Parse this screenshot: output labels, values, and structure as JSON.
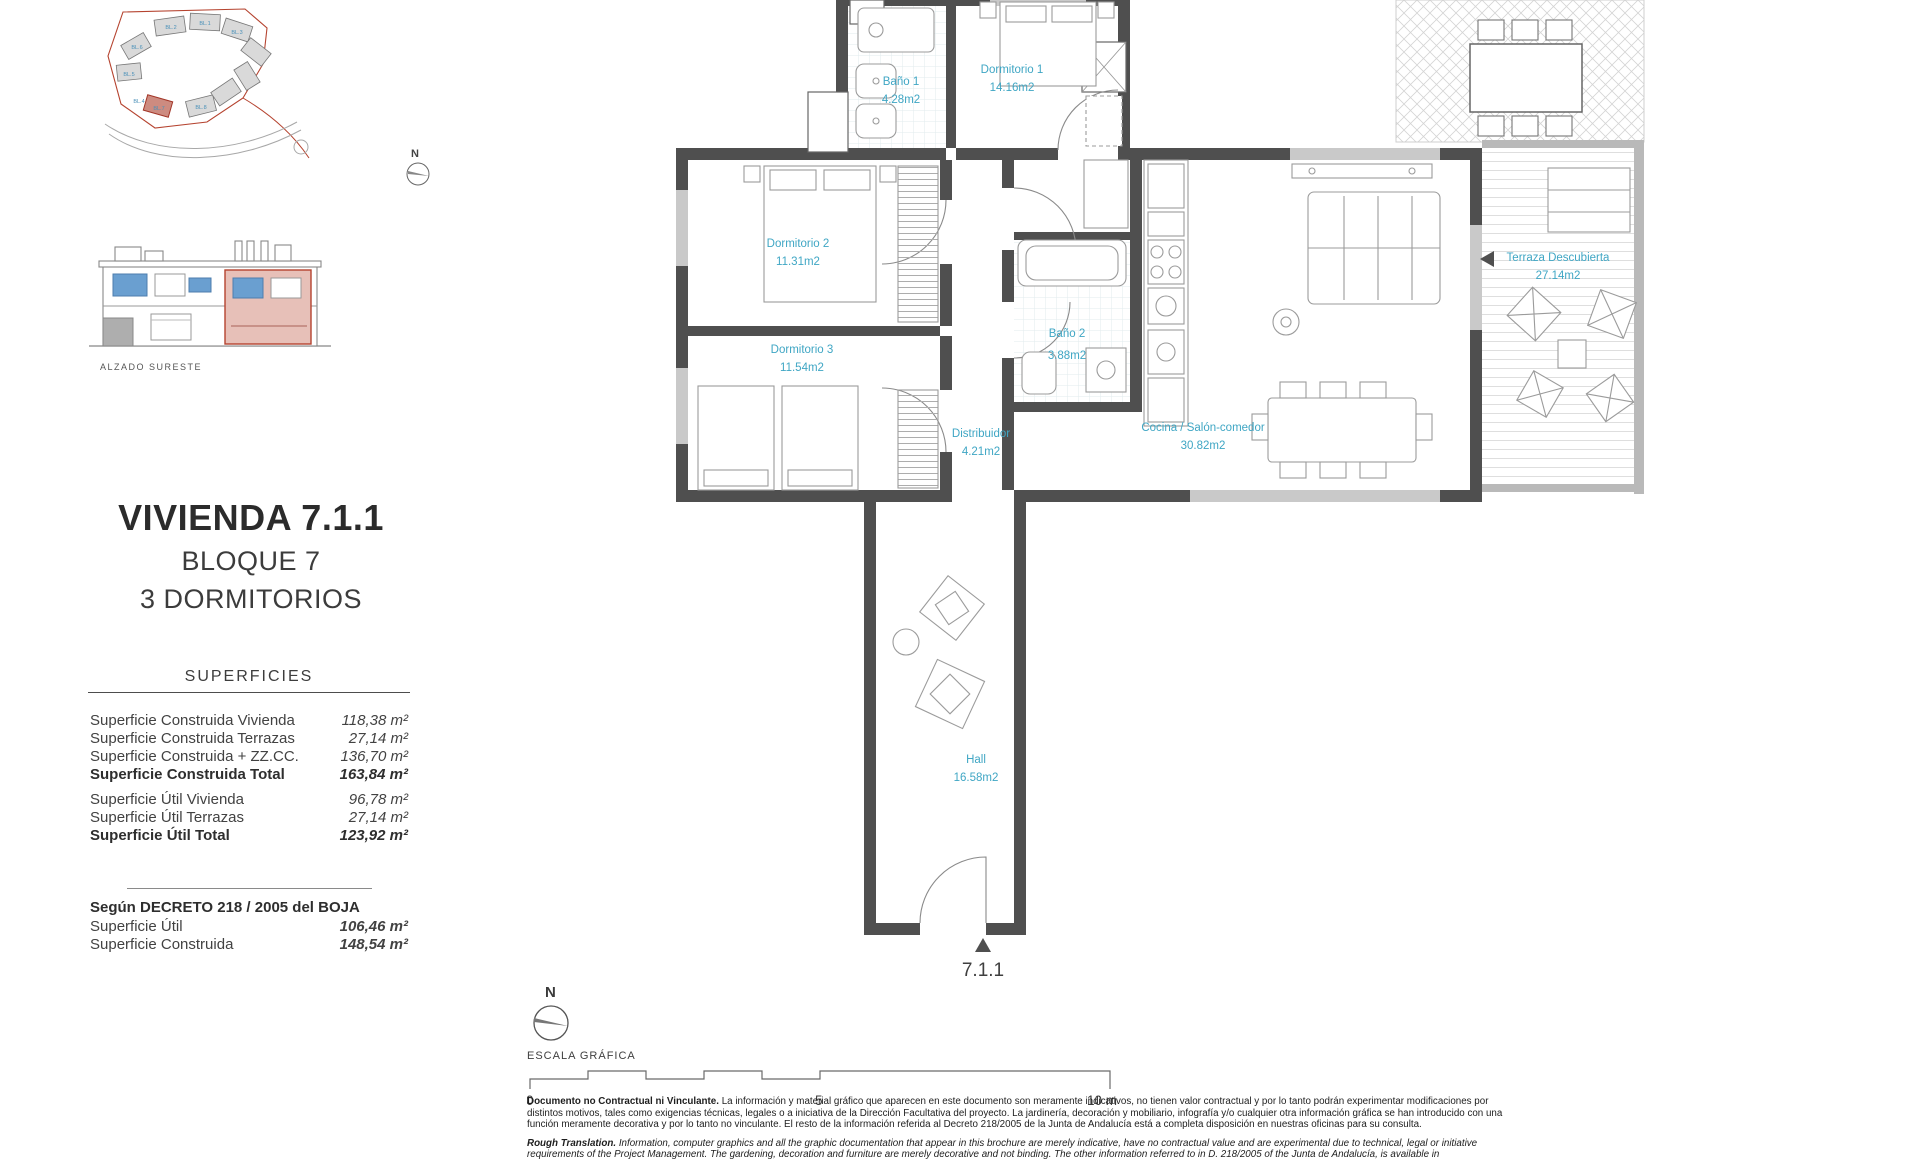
{
  "page_title": "VIVIENDA 7.1.1",
  "subtitle_block": "BLOQUE 7",
  "subtitle_rooms": "3 DORMITORIOS",
  "north": {
    "label": "N"
  },
  "site_plan": {
    "block_labels": [
      "BL.1",
      "BL.2",
      "BL.3",
      "BL.4",
      "BL.5",
      "BL.6",
      "BL.7",
      "BL.8"
    ]
  },
  "elevation": {
    "caption": "ALZADO SURESTE"
  },
  "superficies": {
    "header": "SUPERFICIES",
    "construida_rows": [
      {
        "label": "Superficie Construida Vivienda",
        "value": "118,38 m²"
      },
      {
        "label": "Superficie Construida Terrazas",
        "value": "27,14 m²"
      },
      {
        "label": "Superficie Construida + ZZ.CC.",
        "value": "136,70 m²"
      },
      {
        "label": "Superficie Construida Total",
        "value": "163,84 m²"
      }
    ],
    "util_rows": [
      {
        "label": "Superficie Útil Vivienda",
        "value": "96,78 m²"
      },
      {
        "label": "Superficie Útil Terrazas",
        "value": "27,14 m²"
      },
      {
        "label": "Superficie Útil Total",
        "value": "123,92 m²"
      }
    ],
    "decreto": {
      "lead": "Según DECRETO 218 / 2005 del BOJA",
      "rows": [
        {
          "label": "Superficie Útil",
          "value": "106,46 m²"
        },
        {
          "label": "Superficie Construida",
          "value": "148,54 m²"
        }
      ]
    }
  },
  "floor_plan": {
    "label_color": "#3fa6c4",
    "unit_label": "7.1.1",
    "rooms": [
      {
        "name": "Baño 1",
        "area": "4.28m2"
      },
      {
        "name": "Dormitorio 1",
        "area": "14.16m2"
      },
      {
        "name": "Dormitorio 2",
        "area": "11.31m2"
      },
      {
        "name": "Dormitorio 3",
        "area": "11.54m2"
      },
      {
        "name": "Baño 2",
        "area": "3.88m2"
      },
      {
        "name": "Distribuidor",
        "area": "4.21m2"
      },
      {
        "name": "Cocina / Salón-comedor",
        "area": "30.82m2"
      },
      {
        "name": "Terraza Descubierta",
        "area": "27.14m2"
      },
      {
        "name": "Hall",
        "area": "16.58m2"
      }
    ]
  },
  "scale": {
    "caption": "ESCALA GRÁFICA",
    "ticks": [
      "0",
      "5",
      "10 m"
    ]
  },
  "legal": {
    "p1_lead": "Documento no Contractual ni Vinculante.",
    "p1_text": "La información y material gráfico que aparecen en este documento son meramente indicativos, no tienen valor contractual y por lo tanto podrán experimentar modificaciones por distintos motivos, tales como exigencias técnicas, legales o a iniciativa de la Dirección Facultativa del proyecto. La jardinería, decoración y mobiliario, infografía y/o cualquier otra información gráfica se han introducido con una función meramente decorativa y por lo tanto no vinculante. El resto de la información referida al Decreto 218/2005 de la Junta de Andalucía está a completa disposición en nuestras oficinas para su consulta.",
    "p2_lead": "Rough Translation.",
    "p2_text": "Information, computer graphics and all the graphic documentation that appear in this brochure are merely indicative, have no contractual value and are experimental due to technical, legal or initiative requirements of the Project Management. The gardening, decoration and furniture are merely decorative and not binding. The other information referred to in D. 218/2005 of the Junta de Andalucía, is available in"
  }
}
